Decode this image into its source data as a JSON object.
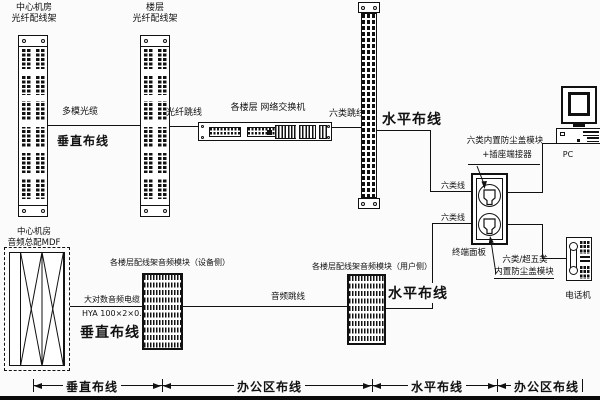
{
  "diagram": {
    "colors": {
      "ink": "#111111",
      "background": "#fbfbfb"
    },
    "fiber_frame_central": {
      "label_line1": "中心机房",
      "label_line2": "光纤配线架"
    },
    "fiber_frame_floor": {
      "label_line1": "楼层",
      "label_line2": "光纤配线架"
    },
    "switch": {
      "label": "各楼层 网络交换机"
    },
    "cables": {
      "multimode": "多模光缆",
      "fiber_jumper": "光纤跳线",
      "cat6_jumper": "六类跳线",
      "cat6_line_data": "六类线",
      "cat6_line_voice": "六类线",
      "audio_jumper": "音频跳线",
      "big_pair_audio": "大对数音频电缆",
      "big_pair_spec": "HYA 100×2×0.5"
    },
    "zones": {
      "vertical_top": "垂直布线",
      "horizontal_top": "水平布线",
      "vertical_bottom": "垂直布线",
      "horizontal_bottom": "水平布线"
    },
    "outlet": {
      "module_top_line1": "六类内置防尘盖模块",
      "module_top_line2": "+插座端接器",
      "panel_label": "终端面板",
      "module_bottom_line1": "六类/超五类",
      "module_bottom_line2": "内置防尘盖模块"
    },
    "devices": {
      "pc": "PC",
      "phone": "电话机"
    },
    "mdf": {
      "label_line1": "中心机房",
      "label_line2": "音频总配MDF"
    },
    "audio_device_side": "各楼层配线架音频模块（设备侧）",
    "audio_user_side": "各楼层配线架音频模块（用户侧）",
    "dimension_labels": [
      "垂直布线",
      "办公区布线",
      "水平布线",
      "办公区布线"
    ]
  }
}
